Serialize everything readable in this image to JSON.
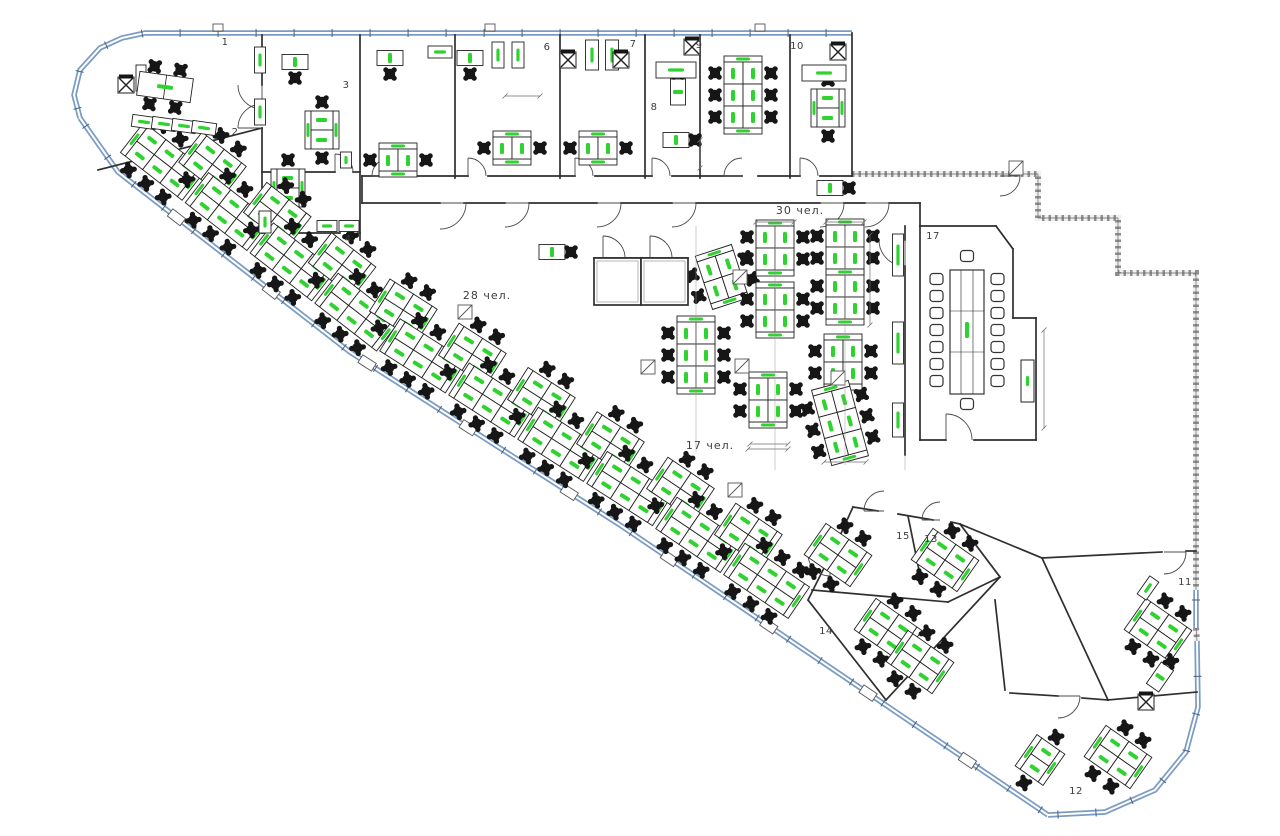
{
  "drawing": {
    "canvas": {
      "w": 1280,
      "h": 836,
      "bg": "#ffffff"
    },
    "colors": {
      "line": "#2f2f2f",
      "wallBase": "#f0f0f0",
      "hatch": "#8f8f8f",
      "glazing": "#7b9cc2",
      "glazingCore": "#ffffff",
      "glazingTick": "#45607d",
      "desk": "#ffffff",
      "chair": "#161616",
      "green": "#2fd32f",
      "dim": "#6f6f6f",
      "door": "#4a4a4a",
      "label": "#3c3c3c"
    },
    "labels": {
      "rooms": [
        {
          "t": "1",
          "x": 225,
          "y": 43
        },
        {
          "t": "2",
          "x": 235,
          "y": 133
        },
        {
          "t": "3",
          "x": 346,
          "y": 86
        },
        {
          "t": "4",
          "x": 348,
          "y": 240
        },
        {
          "t": "6",
          "x": 547,
          "y": 48
        },
        {
          "t": "7",
          "x": 633,
          "y": 45
        },
        {
          "t": "8",
          "x": 654,
          "y": 108
        },
        {
          "t": "9",
          "x": 699,
          "y": 46
        },
        {
          "t": "10",
          "x": 797,
          "y": 47
        },
        {
          "t": "11",
          "x": 1185,
          "y": 583
        },
        {
          "t": "12",
          "x": 1076,
          "y": 792
        },
        {
          "t": "13",
          "x": 931,
          "y": 540
        },
        {
          "t": "14",
          "x": 826,
          "y": 632
        },
        {
          "t": "15",
          "x": 903,
          "y": 537
        },
        {
          "t": "17",
          "x": 933,
          "y": 237
        }
      ],
      "zones": [
        {
          "t": "30 чел.",
          "x": 800,
          "y": 211
        },
        {
          "t": "28 чел.",
          "x": 487,
          "y": 296
        },
        {
          "t": "17 чел.",
          "x": 710,
          "y": 446
        }
      ]
    },
    "glazingRuns": [
      [
        [
          80,
          118
        ],
        [
          74,
          95
        ],
        [
          80,
          70
        ],
        [
          100,
          48
        ],
        [
          122,
          38
        ],
        [
          145,
          33
        ],
        [
          852,
          33
        ]
      ],
      [
        [
          80,
          118
        ],
        [
          118,
          172
        ],
        [
          350,
          352
        ],
        [
          620,
          525
        ],
        [
          1048,
          815
        ]
      ],
      [
        [
          1048,
          815
        ],
        [
          1105,
          812
        ],
        [
          1155,
          790
        ],
        [
          1186,
          752
        ],
        [
          1198,
          707
        ],
        [
          1197,
          640
        ]
      ],
      [
        [
          1196,
          590
        ],
        [
          1196,
          628
        ]
      ]
    ],
    "hatchedRuns": [
      [
        [
          852,
          174
        ],
        [
          1038,
          174
        ],
        [
          1038,
          218
        ],
        [
          1118,
          218
        ],
        [
          1118,
          273
        ],
        [
          1196,
          273
        ],
        [
          1196,
          590
        ]
      ],
      [
        [
          1196,
          628
        ],
        [
          1197,
          641
        ]
      ]
    ],
    "joints": [
      [
        218,
        33
      ],
      [
        490,
        33
      ],
      [
        760,
        33
      ]
    ],
    "walls": [
      [
        262,
        35,
        262,
        85
      ],
      [
        262,
        128,
        262,
        233
      ],
      [
        98,
        170,
        262,
        128
      ],
      [
        262,
        172,
        335,
        172
      ],
      [
        353,
        172,
        360,
        172
      ],
      [
        262,
        233,
        340,
        233
      ],
      [
        358,
        233,
        360,
        233
      ],
      [
        360,
        35,
        360,
        240
      ],
      [
        455,
        35,
        455,
        178
      ],
      [
        560,
        35,
        560,
        178
      ],
      [
        645,
        35,
        645,
        178
      ],
      [
        700,
        35,
        700,
        178
      ],
      [
        790,
        35,
        790,
        178
      ],
      [
        852,
        33,
        852,
        176
      ],
      [
        362,
        176,
        380,
        176
      ],
      [
        400,
        176,
        468,
        176
      ],
      [
        488,
        176,
        575,
        176
      ],
      [
        595,
        176,
        652,
        176
      ],
      [
        672,
        176,
        742,
        176
      ],
      [
        758,
        176,
        800,
        176
      ],
      [
        820,
        176,
        852,
        176
      ],
      [
        362,
        176,
        362,
        203
      ],
      [
        362,
        203,
        440,
        203
      ],
      [
        464,
        203,
        505,
        203
      ],
      [
        529,
        203,
        597,
        203
      ],
      [
        621,
        203,
        672,
        203
      ],
      [
        696,
        203,
        820,
        203
      ],
      [
        844,
        203,
        865,
        203
      ],
      [
        889,
        203,
        920,
        203
      ],
      [
        920,
        203,
        920,
        226
      ],
      [
        905,
        226,
        905,
        240
      ],
      [
        905,
        266,
        905,
        455
      ],
      [
        920,
        226,
        996,
        226
      ],
      [
        996,
        226,
        1013,
        249
      ],
      [
        1013,
        249,
        1013,
        318
      ],
      [
        1013,
        318,
        1036,
        318
      ],
      [
        1036,
        318,
        1036,
        440
      ],
      [
        920,
        440,
        946,
        440
      ],
      [
        974,
        440,
        1036,
        440
      ],
      [
        920,
        226,
        920,
        440
      ],
      [
        594,
        258,
        688,
        258
      ],
      [
        960,
        524,
        1042,
        558
      ],
      [
        853,
        507,
        878,
        511
      ],
      [
        898,
        514,
        933,
        520
      ],
      [
        951,
        522,
        960,
        524
      ],
      [
        960,
        524,
        1000,
        577
      ],
      [
        1000,
        577,
        886,
        700
      ],
      [
        886,
        700,
        808,
        600
      ],
      [
        808,
        600,
        826,
        564
      ],
      [
        838,
        540,
        853,
        507
      ],
      [
        812,
        590,
        948,
        602
      ],
      [
        948,
        602,
        1000,
        577
      ],
      [
        908,
        516,
        919,
        570
      ],
      [
        1042,
        558,
        1162,
        552
      ],
      [
        1186,
        551,
        1196,
        551
      ],
      [
        1042,
        558,
        1108,
        700
      ],
      [
        1010,
        693,
        1058,
        696
      ],
      [
        1082,
        698,
        1108,
        700
      ],
      [
        1108,
        700,
        1197,
        692
      ],
      [
        1005,
        690,
        995,
        600
      ]
    ],
    "doors": [
      [
        440,
        203,
        26,
        0,
        90
      ],
      [
        505,
        203,
        24,
        0,
        90
      ],
      [
        597,
        203,
        24,
        0,
        90
      ],
      [
        672,
        203,
        24,
        0,
        90
      ],
      [
        820,
        203,
        24,
        0,
        90
      ],
      [
        865,
        203,
        24,
        0,
        90
      ],
      [
        390,
        176,
        18,
        180,
        270
      ],
      [
        468,
        176,
        18,
        270,
        360
      ],
      [
        575,
        176,
        18,
        270,
        360
      ],
      [
        652,
        176,
        18,
        270,
        360
      ],
      [
        742,
        176,
        18,
        180,
        270
      ],
      [
        800,
        176,
        18,
        270,
        360
      ],
      [
        262,
        85,
        24,
        90,
        180
      ],
      [
        262,
        128,
        24,
        180,
        270
      ],
      [
        335,
        172,
        18,
        270,
        360
      ],
      [
        603,
        258,
        22,
        270,
        360
      ],
      [
        650,
        258,
        22,
        270,
        360
      ],
      [
        946,
        440,
        26,
        270,
        360
      ],
      [
        1000,
        176,
        20,
        0,
        90
      ],
      [
        905,
        240,
        26,
        90,
        180
      ],
      [
        884,
        511,
        20,
        180,
        270
      ],
      [
        940,
        520,
        18,
        180,
        270
      ],
      [
        1164,
        552,
        22,
        0,
        90
      ],
      [
        1058,
        696,
        22,
        0,
        90
      ],
      [
        830,
        554,
        22,
        90,
        180
      ]
    ],
    "bandZone": {
      "wall": [
        [
          80,
          118
        ],
        [
          118,
          172
        ],
        [
          350,
          352
        ],
        [
          620,
          525
        ],
        [
          1048,
          815
        ]
      ],
      "start": 95,
      "step": 41,
      "count": 19,
      "near": 36,
      "far": 64
    },
    "clusters": [
      [
        722,
        277,
        2,
        -18
      ],
      [
        696,
        355,
        3,
        0
      ],
      [
        775,
        248,
        2,
        0
      ],
      [
        775,
        310,
        2,
        0
      ],
      [
        768,
        400,
        2,
        0
      ],
      [
        845,
        247,
        2,
        0
      ],
      [
        845,
        297,
        2,
        0
      ],
      [
        843,
        362,
        2,
        0
      ],
      [
        840,
        423,
        3,
        -15
      ],
      [
        743,
        95,
        3,
        0
      ],
      [
        838,
        555,
        2,
        -55
      ],
      [
        945,
        560,
        2,
        -55
      ],
      [
        888,
        630,
        2,
        -55
      ],
      [
        920,
        662,
        2,
        -55
      ],
      [
        1158,
        630,
        2,
        -55
      ],
      [
        1118,
        757,
        2,
        -55
      ]
    ],
    "benches": [
      [
        322,
        130,
        90
      ],
      [
        288,
        188,
        90
      ],
      [
        398,
        160,
        0
      ],
      [
        512,
        148,
        0
      ],
      [
        598,
        148,
        0
      ],
      [
        828,
        108,
        90
      ],
      [
        1040,
        760,
        -55
      ]
    ],
    "workstations": [
      [
        295,
        62,
        0,
        "S"
      ],
      [
        390,
        58,
        0,
        "S"
      ],
      [
        470,
        58,
        0,
        "S"
      ],
      [
        678,
        92,
        90,
        "W"
      ],
      [
        676,
        140,
        0,
        "E"
      ],
      [
        830,
        188,
        0,
        "E"
      ],
      [
        552,
        252,
        0,
        "E"
      ],
      [
        1160,
        677,
        -55,
        "E"
      ]
    ],
    "tables": [
      [
        676,
        70,
        40,
        16
      ],
      [
        824,
        73,
        44,
        16
      ]
    ],
    "meeting1": {
      "cx": 165,
      "cy": 87,
      "rot": 8
    },
    "cabinets": [
      [
        260,
        60,
        90,
        26,
        11
      ],
      [
        260,
        112,
        90,
        26,
        11
      ],
      [
        141,
        78,
        90,
        26,
        10
      ],
      [
        144,
        122,
        8,
        24,
        12
      ],
      [
        164,
        124,
        8,
        24,
        12
      ],
      [
        184,
        126,
        8,
        24,
        12
      ],
      [
        204,
        128,
        8,
        24,
        12
      ],
      [
        346,
        160,
        90,
        16,
        11
      ],
      [
        265,
        222,
        90,
        22,
        12
      ],
      [
        327,
        226,
        0,
        20,
        11
      ],
      [
        349,
        226,
        0,
        20,
        11
      ],
      [
        440,
        52,
        0,
        24,
        12
      ],
      [
        498,
        55,
        90,
        26,
        12
      ],
      [
        518,
        55,
        90,
        26,
        12
      ],
      [
        592,
        55,
        90,
        30,
        13
      ],
      [
        612,
        55,
        90,
        30,
        13
      ],
      [
        898,
        255,
        90,
        42,
        11
      ],
      [
        898,
        343,
        90,
        42,
        11
      ],
      [
        898,
        420,
        90,
        34,
        11
      ],
      [
        1148,
        588,
        -55,
        22,
        11
      ]
    ],
    "xchairs": [
      [
        126,
        85
      ],
      [
        568,
        60
      ],
      [
        621,
        60
      ],
      [
        692,
        47
      ],
      [
        838,
        52
      ],
      [
        1146,
        702
      ]
    ],
    "slashBoxes": [
      [
        633,
        278
      ],
      [
        740,
        277
      ],
      [
        742,
        366
      ],
      [
        648,
        367
      ],
      [
        838,
        378
      ],
      [
        735,
        490
      ],
      [
        465,
        312
      ],
      [
        1016,
        168
      ]
    ],
    "pods": [
      [
        594,
        258,
        47,
        47
      ],
      [
        641,
        258,
        47,
        47
      ]
    ],
    "conference": {
      "table": [
        950,
        270,
        34,
        124
      ],
      "chairCols": [
        936.5,
        997.5
      ],
      "chairYs": [
        279,
        296,
        313,
        330,
        347,
        364,
        381
      ],
      "endChairs": [
        [
          967,
          256
        ],
        [
          967,
          404
        ]
      ],
      "credenza": [
        1021,
        360,
        13,
        42
      ],
      "pill": [
        967,
        330
      ]
    },
    "dims": [
      [
        756,
        222,
        794,
        222
      ],
      [
        826,
        222,
        864,
        222
      ],
      [
        870,
        235,
        870,
        325
      ],
      [
        750,
        444,
        788,
        444
      ],
      [
        824,
        462,
        866,
        462
      ],
      [
        748,
        449,
        788,
        449
      ],
      [
        1044,
        330,
        1044,
        428
      ],
      [
        700,
        140,
        700,
        168
      ],
      [
        505,
        96,
        540,
        96
      ]
    ],
    "leaders": [
      [
        696,
        226,
        696,
        452
      ],
      [
        775,
        226,
        775,
        470
      ],
      [
        845,
        226,
        845,
        465
      ],
      [
        905,
        455,
        905,
        470
      ]
    ]
  }
}
